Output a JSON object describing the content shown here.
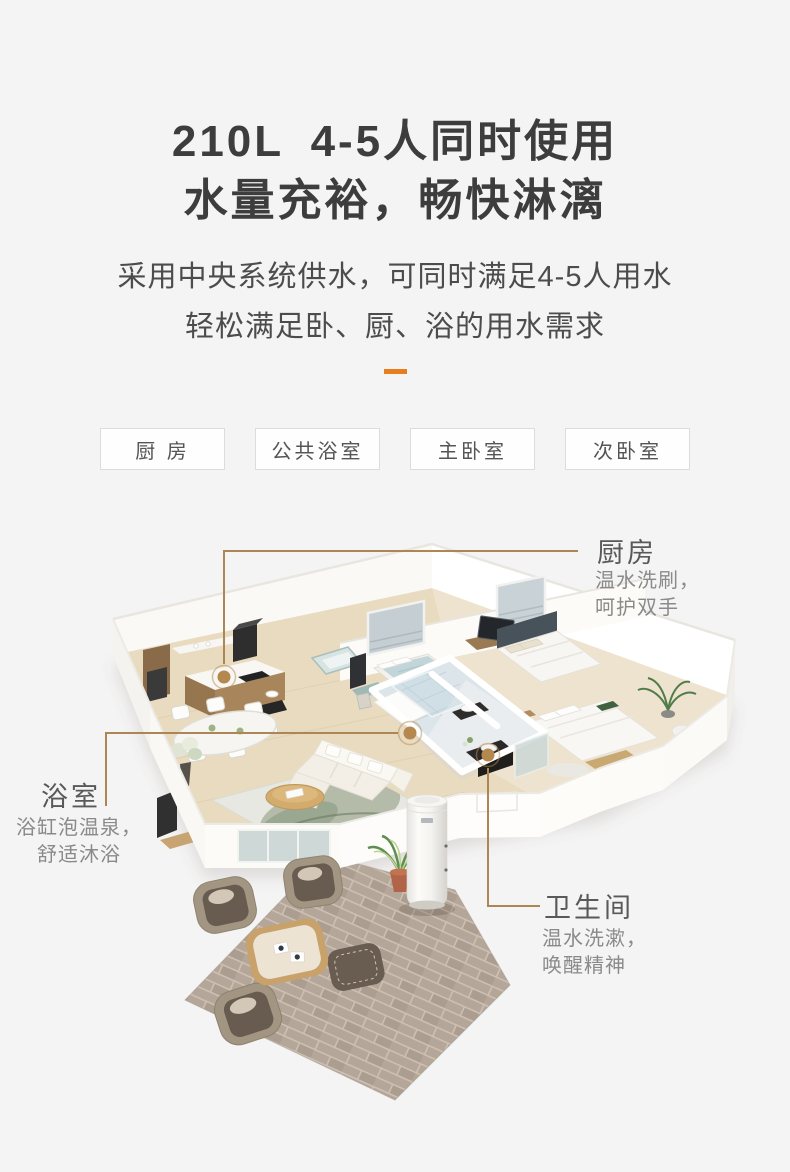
{
  "colors": {
    "accent": "#e87d1f",
    "line": "#ad8656",
    "dot": "#b5894e",
    "bg": "#f4f4f4"
  },
  "header": {
    "title_line1": "210L 4-5人同时使用",
    "title_line2": "水量充裕，畅快淋漓",
    "subtitle_line1": "采用中央系统供水，可同时满足4-5人用水",
    "subtitle_line2": "轻松满足卧、厨、浴的用水需求"
  },
  "room_tags": [
    {
      "label": "厨 房"
    },
    {
      "label": "公共浴室"
    },
    {
      "label": "主卧室"
    },
    {
      "label": "次卧室"
    }
  ],
  "callouts": {
    "kitchen": {
      "title": "厨房",
      "desc1": "温水洗刷，",
      "desc2": "呵护双手"
    },
    "bathroom": {
      "title": "浴室",
      "desc1": "浴缸泡温泉，",
      "desc2": "舒适沐浴"
    },
    "washroom": {
      "title": "卫生间",
      "desc1": "温水洗漱，",
      "desc2": "唤醒精神"
    }
  }
}
